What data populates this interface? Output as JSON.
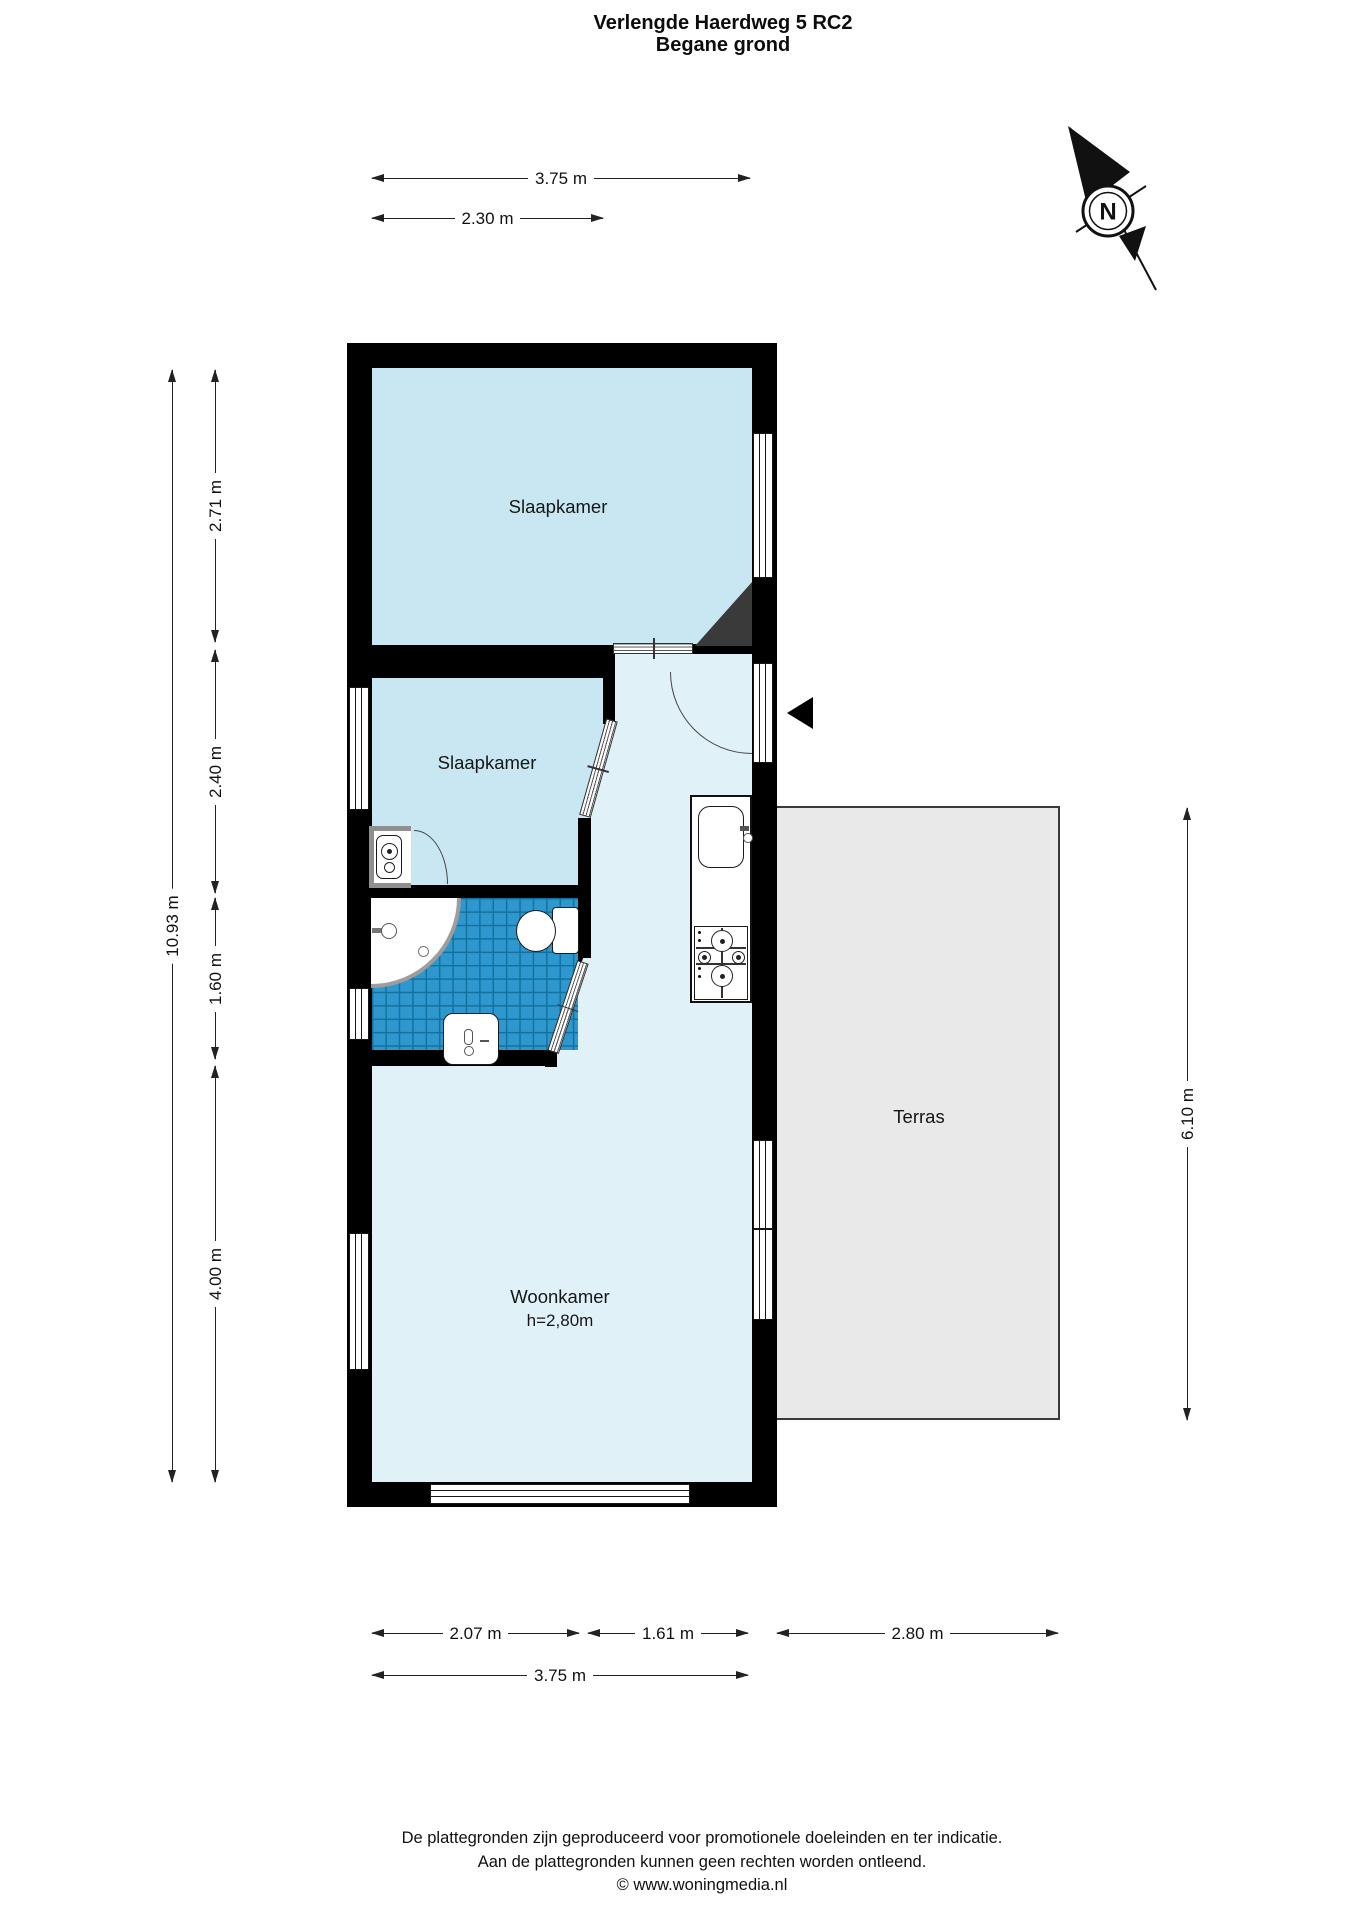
{
  "title": {
    "line1": "Verlengde Haerdweg 5 RC2",
    "line2": "Begane grond"
  },
  "compass": {
    "letter": "N"
  },
  "rooms": {
    "bedroom1": "Slaapkamer",
    "bedroom2": "Slaapkamer",
    "living": "Woonkamer",
    "living_ceiling": "h=2,80m",
    "terrace": "Terras"
  },
  "dims": {
    "width_total_top": "3.75 m",
    "width_bedroom2": "2.30 m",
    "height_total": "10.93 m",
    "height_bedroom1": "2.71 m",
    "height_bedroom2": "2.40 m",
    "height_bathroom": "1.60 m",
    "height_living": "4.00 m",
    "height_terrace": "6.10 m",
    "width_bathroom": "2.07 m",
    "width_hall": "1.61 m",
    "width_terrace": "2.80 m",
    "width_total_bottom": "3.75 m"
  },
  "footer": [
    "De plattegronden zijn geproduceerd voor promotionele doeleinden en ter indicatie.",
    "Aan de plattegronden kunnen geen rechten worden ontleend.",
    "© www.woningmedia.nl"
  ],
  "colors": {
    "wall": "#000000",
    "bedroom_fill": "#c9e7f2",
    "hall_fill": "#e1f1f8",
    "tile_fill": "#2e98ce",
    "tile_grid": "#12719f",
    "terrace_fill": "#e9e9e9",
    "chamfer": "#3a3a3a"
  }
}
